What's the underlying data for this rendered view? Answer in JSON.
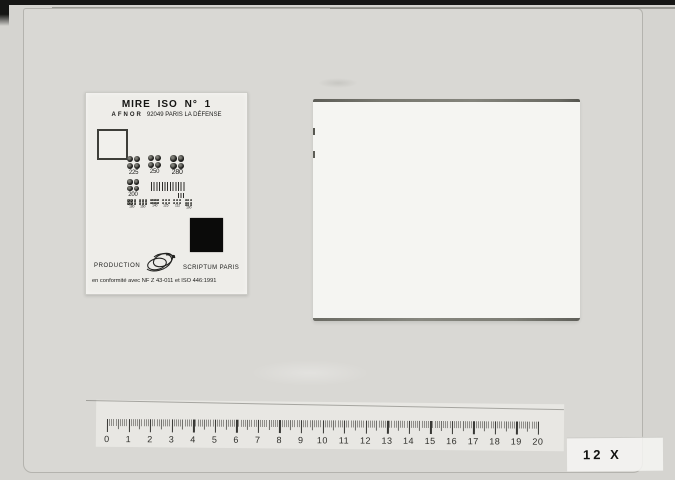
{
  "frame": {
    "magnification_label": "12 X"
  },
  "test_card": {
    "title": "MIRE ISO N° 1",
    "subtitle_org": "AFNOR",
    "subtitle_address": "92049 PARIS LA DÉFENSE",
    "groups_row1": [
      {
        "label": "225"
      },
      {
        "label": "250"
      },
      {
        "label": "280"
      }
    ],
    "group_row2_label": "200",
    "groups_row3": [
      "180",
      "160",
      "140",
      "125",
      "112",
      "100"
    ],
    "production_label": "PRODUCTION",
    "brand_label": "SCRIPTUM PARIS",
    "conformity_text": "en conformité avec NF Z 43-011 et ISO 446:1991"
  },
  "ruler": {
    "numbers": [
      "0",
      "1",
      "2",
      "3",
      "4",
      "5",
      "6",
      "7",
      "8",
      "9",
      "10",
      "11",
      "12",
      "13",
      "14",
      "15",
      "16",
      "17",
      "18",
      "19",
      "20"
    ],
    "minor_ticks_per_unit": 10
  },
  "colors": {
    "photo_background": "#d5d4d0",
    "sheet_background": "#d9d8d4",
    "card_background": "#eeede9",
    "document_background": "#f5f5f2",
    "document_edge": "#6b6b64",
    "ink": "#141412"
  },
  "icons": {
    "logo": "scriptum-swirl-logo"
  }
}
